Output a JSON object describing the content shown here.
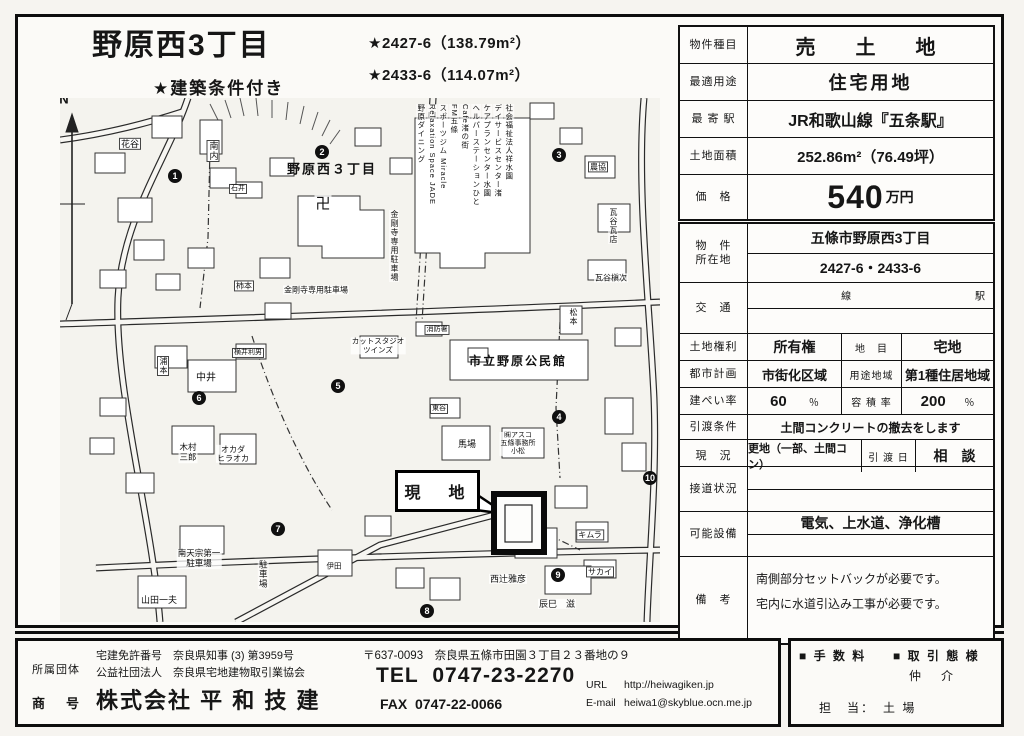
{
  "header": {
    "title": "野原西3丁目",
    "annotation_1": "★2427-6（138.79m²）",
    "annotation_2": "★2433-6（114.07m²）",
    "condition": "★建築条件付き"
  },
  "summary": {
    "rows": [
      {
        "label": "物件種目",
        "value": "売　土　地"
      },
      {
        "label": "最適用途",
        "value": "住宅用地"
      },
      {
        "label": "最 寄 駅",
        "value": "JR和歌山線『五条駅』"
      },
      {
        "label": "土地面積",
        "value": "252.86m²（76.49坪）"
      }
    ],
    "price_label": "価　格",
    "price_value": "540",
    "price_unit": "万円"
  },
  "details": {
    "bukken_label": "物　件\n所在地",
    "location_1": "五條市野原西3丁目",
    "location_2": "2427-6・2433-6",
    "kotsu_label": "交　通",
    "sen": "線",
    "eki": "駅",
    "tochi_kenri_label": "土地権利",
    "tochi_kenri": "所有権",
    "chimoku_label": "地　目",
    "chimoku": "宅地",
    "toshi_keikaku_label": "都市計画",
    "toshi_keikaku": "市街化区域",
    "yoto_label": "用途地域",
    "yoto": "第1種住居地域",
    "kenpei_label": "建ぺい率",
    "kenpei": "60",
    "percent": "％",
    "yoseki_label": "容 積 率",
    "yoseki": "200",
    "joken_label": "引渡条件",
    "joken": "土間コンクリートの撤去をします",
    "genkyo_label": "現　況",
    "genkyo": "更地（一部、土間コン）",
    "hikiwatashibi_label": "引 渡 日",
    "hikiwatashibi": "相　談",
    "setsudo_label": "接道状況",
    "setsubi_label": "可能設備",
    "setsubi": "電気、上水道、浄化槽",
    "biko_label": "備　考",
    "biko_1": "南側部分セットバックが必要です。",
    "biko_2": "宅内に水道引込み工事が必要です。"
  },
  "footer": {
    "shozoku_label": "所属団体",
    "shogo_label": "商　号",
    "license": "宅建免許番号　奈良県知事 (3) 第3959号",
    "association": "公益社団法人　奈良県宅地建物取引業協会",
    "company": "株式会社 平 和 技 建",
    "address": "〒637-0093　奈良県五條市田園３丁目２３番地の９",
    "tel_label": "TEL",
    "tel": "0747-23-2270",
    "fax_label": "FAX",
    "fax": "0747-22-0066",
    "url_label": "URL",
    "url": "http://heiwagiken.jp",
    "email_label": "E-mail",
    "email": "heiwa1@skyblue.ocn.me.jp",
    "fee_label": "■ 手 数 料",
    "torihiki_label": "■ 取 引 態 様",
    "chukai": "仲　介",
    "tanto": "担　当：　土 場"
  },
  "map": {
    "north_label": "N",
    "site_label": "現　地",
    "markers": [
      {
        "n": "1",
        "x": 115,
        "y": 78
      },
      {
        "n": "2",
        "x": 262,
        "y": 54
      },
      {
        "n": "3",
        "x": 499,
        "y": 57
      },
      {
        "n": "4",
        "x": 499,
        "y": 319
      },
      {
        "n": "5",
        "x": 278,
        "y": 288
      },
      {
        "n": "6",
        "x": 139,
        "y": 300
      },
      {
        "n": "7",
        "x": 218,
        "y": 431
      },
      {
        "n": "8",
        "x": 367,
        "y": 513
      },
      {
        "n": "9",
        "x": 498,
        "y": 477
      },
      {
        "n": "10",
        "x": 590,
        "y": 380
      }
    ],
    "labels": [
      {
        "t": "花谷",
        "x": 70,
        "y": 46,
        "s": 9,
        "box": 1
      },
      {
        "t": "南内",
        "x": 153,
        "y": 42,
        "s": 9,
        "o": "v",
        "box": 1
      },
      {
        "t": "野原西３丁目",
        "x": 272,
        "y": 72,
        "s": 13,
        "bold": 1
      },
      {
        "t": "卍",
        "x": 263,
        "y": 106,
        "s": 15
      },
      {
        "t": "金剛寺専用駐車場",
        "x": 334,
        "y": 112,
        "s": 8,
        "o": "v"
      },
      {
        "t": "金剛寺専用駐車場",
        "x": 256,
        "y": 192,
        "s": 8
      },
      {
        "t": "石井",
        "x": 178,
        "y": 91,
        "s": 7,
        "box": 1
      },
      {
        "t": "柿本",
        "x": 184,
        "y": 188,
        "s": 8,
        "box": 1
      },
      {
        "t": "農協",
        "x": 538,
        "y": 69,
        "s": 8,
        "box": 1
      },
      {
        "t": "瓦谷瓦店",
        "x": 553,
        "y": 110,
        "s": 8,
        "o": "v"
      },
      {
        "t": "瓦谷槇次",
        "x": 551,
        "y": 180,
        "s": 8
      },
      {
        "t": "松本",
        "x": 513,
        "y": 210,
        "s": 8,
        "o": "v"
      },
      {
        "t": "カットスタジオ\nツインズ",
        "x": 318,
        "y": 248,
        "s": 7.5
      },
      {
        "t": "消防署",
        "x": 377,
        "y": 232,
        "s": 7,
        "box": 1
      },
      {
        "t": "市立野原公民館",
        "x": 458,
        "y": 264,
        "s": 12,
        "bold": 1
      },
      {
        "t": "横井利男",
        "x": 188,
        "y": 255,
        "s": 7,
        "box": 1
      },
      {
        "t": "浦本",
        "x": 103,
        "y": 258,
        "s": 8,
        "o": "v",
        "box": 1
      },
      {
        "t": "中井",
        "x": 146,
        "y": 280,
        "s": 10
      },
      {
        "t": "東谷",
        "x": 379,
        "y": 311,
        "s": 7,
        "box": 1
      },
      {
        "t": "馬場",
        "x": 407,
        "y": 346,
        "s": 9
      },
      {
        "t": "㈱アスコ\n五條事務所\n小松",
        "x": 458,
        "y": 346,
        "s": 7
      },
      {
        "t": "木村\n三郎",
        "x": 128,
        "y": 355,
        "s": 8.5
      },
      {
        "t": "オカダ\nヒラオカ",
        "x": 173,
        "y": 356,
        "s": 8
      },
      {
        "t": "南天宗第一\n駐車場",
        "x": 139,
        "y": 461,
        "s": 8.5
      },
      {
        "t": "山田一夫",
        "x": 99,
        "y": 502,
        "s": 9
      },
      {
        "t": "駐車場",
        "x": 203,
        "y": 462,
        "s": 8.5,
        "o": "v"
      },
      {
        "t": "伊田",
        "x": 274,
        "y": 469,
        "s": 7.5
      },
      {
        "t": "キムラ",
        "x": 530,
        "y": 437,
        "s": 8,
        "box": 1
      },
      {
        "t": "サカイ",
        "x": 540,
        "y": 474,
        "s": 8,
        "box": 1
      },
      {
        "t": "西辻雅彦",
        "x": 448,
        "y": 481,
        "s": 9
      },
      {
        "t": "辰巳　滋",
        "x": 497,
        "y": 506,
        "s": 9
      },
      {
        "t": "社会福祉法人祥水園",
        "x": 449,
        "y": 6,
        "s": 7.5,
        "o": "v"
      },
      {
        "t": "デイサービスセンター渚",
        "x": 438,
        "y": 6,
        "s": 7.5,
        "o": "v"
      },
      {
        "t": "ケアプランセンター水園",
        "x": 427,
        "y": 6,
        "s": 7.5,
        "o": "v"
      },
      {
        "t": "ヘルパーステーションひと",
        "x": 416,
        "y": 6,
        "s": 7.5,
        "o": "v"
      },
      {
        "t": "Cafe渚の街",
        "x": 405,
        "y": 6,
        "s": 7.5,
        "o": "v"
      },
      {
        "t": "FM五條",
        "x": 394,
        "y": 6,
        "s": 7.5,
        "o": "v"
      },
      {
        "t": "スポーツジム Miracle",
        "x": 383,
        "y": 6,
        "s": 7.5,
        "o": "v"
      },
      {
        "t": "Relaxation Space JADE",
        "x": 372,
        "y": 6,
        "s": 7.5,
        "o": "v"
      },
      {
        "t": "野原ダイニング",
        "x": 361,
        "y": 6,
        "s": 7.5,
        "o": "v"
      }
    ]
  }
}
